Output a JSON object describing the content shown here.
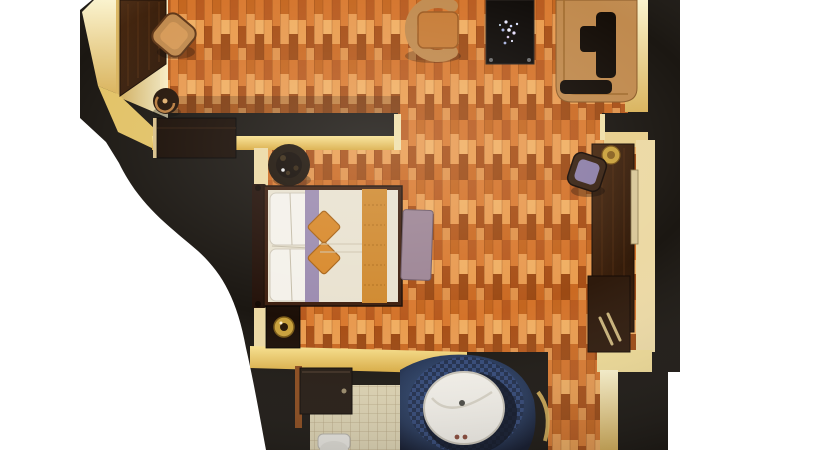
{
  "scene": {
    "title": "hotel-guest-room-3d-floor-plan",
    "view": "top-down-render",
    "rooms": [
      {
        "name": "living-room",
        "furniture": [
          "console-table",
          "accent-chair",
          "side-stool",
          "armchair",
          "coffee-table-with-flowers",
          "sofa-with-dark-throw"
        ]
      },
      {
        "name": "bedroom",
        "furniture": [
          "wardrobe-closet",
          "potted-plant",
          "double-bed-with-orange-runner",
          "foot-bench",
          "nightstand-with-lamp"
        ]
      },
      {
        "name": "dressing-area",
        "furniture": [
          "desk-console",
          "gold-bowl",
          "desk-chair-purple-cushion",
          "wall-mirror",
          "luggage-bench"
        ]
      },
      {
        "name": "bathroom",
        "furniture": [
          "dark-cabinet",
          "round-sink-navy-counter",
          "toilet",
          "curved-glass-door"
        ]
      },
      {
        "name": "entry-corridor",
        "furniture": []
      }
    ],
    "palette": {
      "background": "#ffffff",
      "wall": "#1b1712",
      "wood_base": "#c96a28",
      "cream": "#f0dfa8",
      "cream_corner": "#e2c266",
      "yellow_wall": "#f3d678",
      "dark_wood": "#3b2010",
      "wardrobe": "#190d05",
      "tan": "#c08a4e",
      "seat_orange": "#c67b35",
      "table_black": "#0f0b08",
      "throw_dark": "#150e08",
      "bed_white": "#e9e2d0",
      "pillow_white": "#f4f1ea",
      "purple_runner": "#9c8cb0",
      "bench_mauve": "#9d8595",
      "cushion_purple": "#8d7fa8",
      "accent_orange": "#d8892b",
      "runner_orange": "#d08a30",
      "gold": "#c9a13c",
      "navy": "#233455",
      "tile": "#ddd3b2",
      "sink_white": "#f3f0e9",
      "toilet_white": "#e8e6e0",
      "mirror": "#d9c89a",
      "headboard": "#24120a",
      "bed_frame": "#3f2010"
    }
  }
}
